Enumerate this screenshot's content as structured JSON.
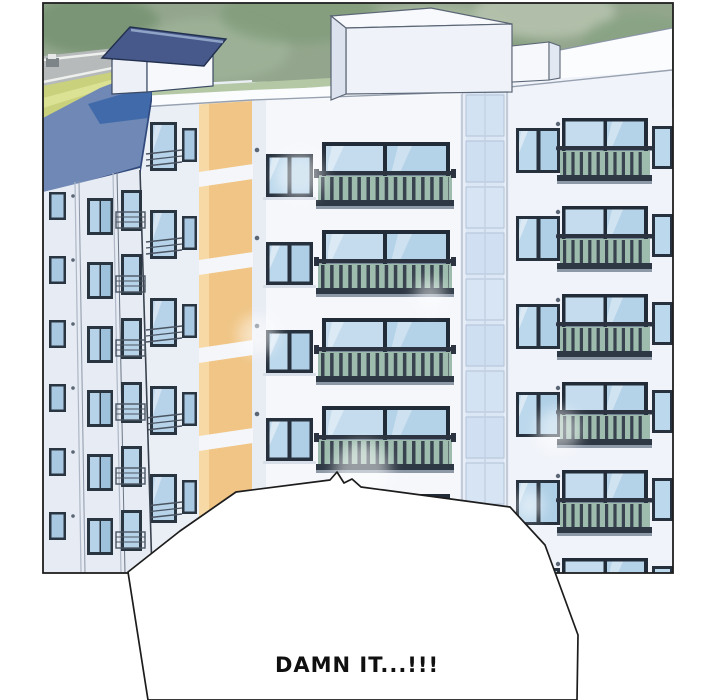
{
  "page": {
    "kind": "webtoon-comic-panel",
    "background_color": "#ffffff"
  },
  "panel": {
    "border_color": "#1f1f1f",
    "scene_elements": [
      "tree-foliage-background",
      "street-with-curb-lines",
      "grass-field",
      "blue-roof-apartment-tower",
      "rooftop-house-with-gabled-navy-roof",
      "white-apartment-building-with-orange-accent-stripes",
      "frosted-glass-stairwell-column",
      "french-balconies-with-railings",
      "window-grid"
    ]
  },
  "speech_bubble": {
    "text": "DAMN IT...!!!",
    "fill_color": "#ffffff",
    "outline_color": "#1c1c1c"
  },
  "colors": {
    "foliage-green": "#93a68d",
    "roof-blue": "#6f88b5",
    "roof-blue-dark": "#3c67a9",
    "roof-fascia": "#30497c",
    "accent-orange": "#f0c585",
    "wall-white": "#f5f7fb",
    "wall-side": "#eaeef5",
    "wall-right": "#f0f3f9",
    "window-frame": "#27313d",
    "glass-blue": "#bcd8ec",
    "balcony-glass-green": "#9dbcae",
    "railing-dark": "#39434f",
    "field-green": "#c9d17d",
    "road-gray": "#b6babb",
    "house-roof-navy": "#47598a",
    "panel-border": "#1f1f1f",
    "bubble-outline": "#1c1c1c"
  }
}
